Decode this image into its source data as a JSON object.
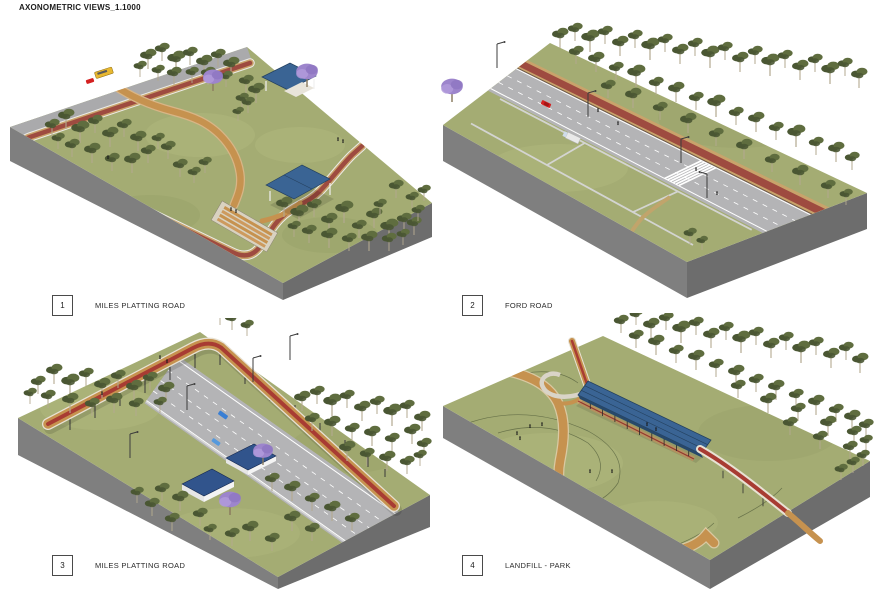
{
  "title": "AXONOMETRIC VIEWS_1.1000",
  "views": [
    {
      "number": "1",
      "label": "MILES PLATTING ROAD"
    },
    {
      "number": "2",
      "label": "FORD ROAD"
    },
    {
      "number": "3",
      "label": "MILES PLATTING ROAD"
    },
    {
      "number": "4",
      "label": "LANDFILL - PARK"
    }
  ],
  "colors": {
    "grass": "#a4ac73",
    "grassLight": "#b9c084",
    "grassDark": "#8d9660",
    "baseSide": "#7f7f7f",
    "baseSideDark": "#6d6d6d",
    "road": "#b4b4b6",
    "roadLine": "#ffffff",
    "cycleRed": "#9e4b40",
    "stripeRed": "#a83c33",
    "pathTan": "#c6924f",
    "pathEdge": "#c9a36b",
    "casing": "#e8e2d4",
    "treeDark": "#4a5733",
    "treeMid": "#5f6d3f",
    "trunkPale": "#b3a98f",
    "jacaranda": "#9d85cc",
    "jacarandaLight": "#b29adb",
    "jacarandaDark": "#8f77c2",
    "roofBlue": "#3a6494",
    "roofBlueDark": "#24415f",
    "carRed": "#d42020",
    "carBlue": "#3a7fd4",
    "busYellow": "#e8b830",
    "fence": "#d6d6d6",
    "person": "#1a1a1a",
    "contour": "#5a6540"
  }
}
